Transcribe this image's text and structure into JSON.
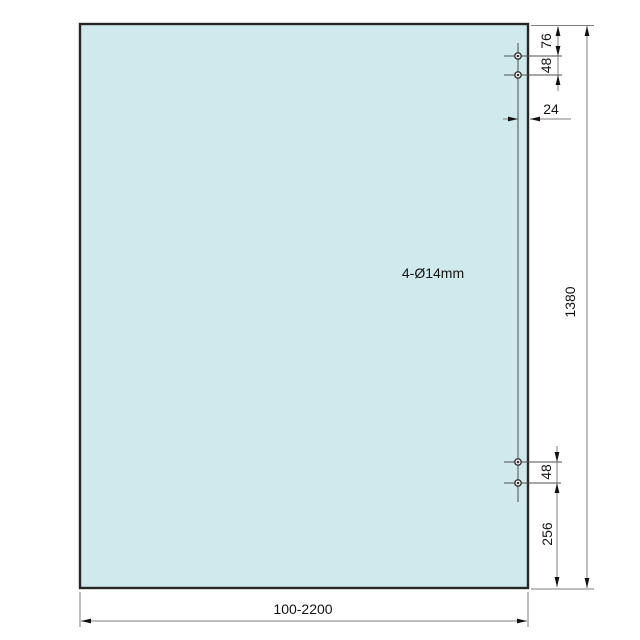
{
  "drawing": {
    "annotation": "4-Ø14mm",
    "dimensions": {
      "width": "100-2200",
      "height": "1380",
      "top_edge_to_first_hole": "76",
      "top_hole_spacing": "48",
      "hole_to_right_edge": "24",
      "bottom_hole_spacing": "48",
      "bottom_edge_to_hole": "256"
    },
    "colors": {
      "panel_fill": "#cfe9ec",
      "panel_border": "#262626",
      "dimension_lines": "#7f7f7f",
      "text": "#141414"
    }
  }
}
